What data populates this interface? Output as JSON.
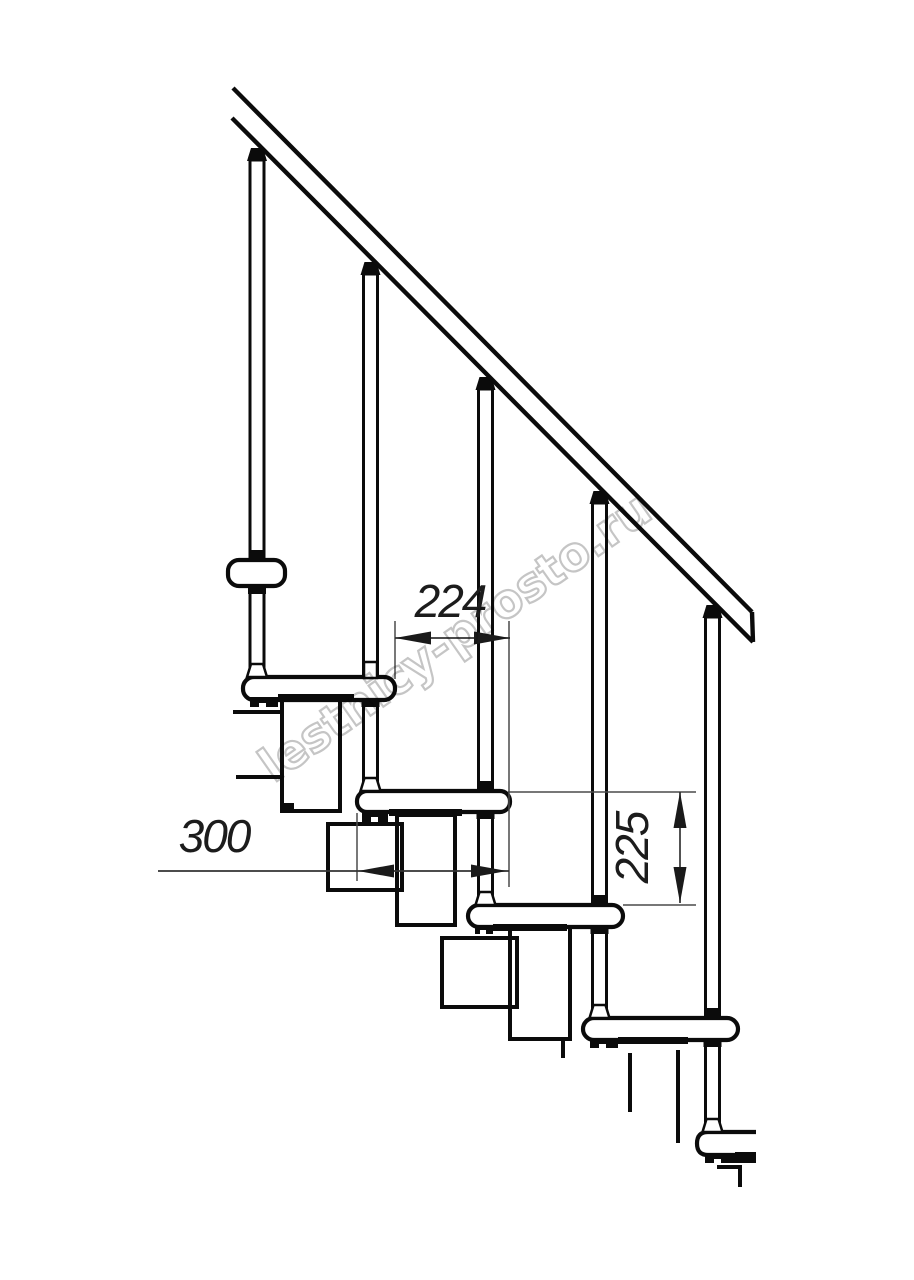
{
  "page": {
    "background": "#ffffff"
  },
  "drawing": {
    "kind": "staircase side elevation technical drawing",
    "line_color": "#0b0b0b",
    "dim_line_color": "#4a4a4a",
    "dim_text_color": "#1c1c1c",
    "connector_gray": "#a0a0a0",
    "dimensions": {
      "run": {
        "value": "224"
      },
      "depth": {
        "value": "300"
      },
      "rise": {
        "value": "225"
      }
    },
    "watermark": {
      "text": "lestnicy-prosto.ru",
      "color": "#c5c5c5"
    }
  }
}
